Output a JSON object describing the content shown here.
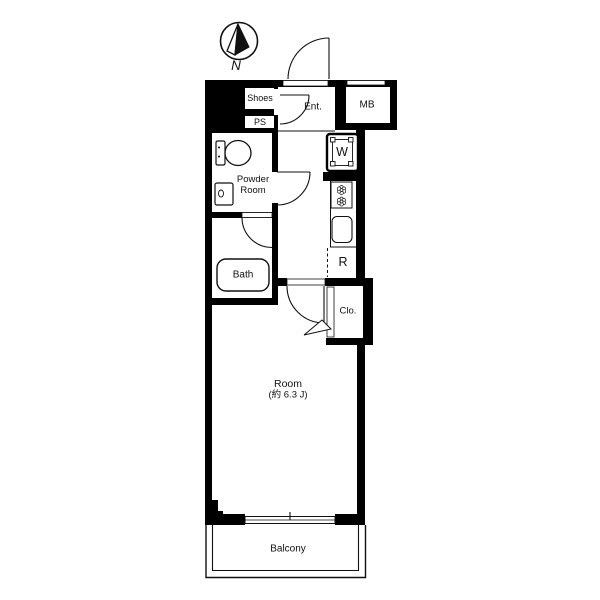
{
  "compass": {
    "north_label": "N"
  },
  "labels": {
    "shoes": "Shoes",
    "ps": "PS",
    "entrance": "Ent.",
    "meter_box": "MB",
    "washer": "W",
    "powder_room_line1": "Powder",
    "powder_room_line2": "Room",
    "bath": "Bath",
    "refrigerator": "R",
    "closet": "Clo.",
    "room": "Room",
    "room_size": "(約 6.3 J)",
    "balcony": "Balcony"
  },
  "icons": {
    "compass": "compass-north-arrow",
    "toilet": "toilet-icon",
    "washbasin": "washbasin-icon",
    "bathtub": "bathtub-icon",
    "washer_pan": "washing-machine-pan-icon",
    "stove": "two-burner-stove-icon",
    "sink": "kitchen-sink-icon",
    "window": "sliding-window-icon",
    "folding_door": "closet-folding-door-icon"
  },
  "colors": {
    "wall": "#000000",
    "line": "#1a1a1a",
    "background": "#ffffff"
  }
}
